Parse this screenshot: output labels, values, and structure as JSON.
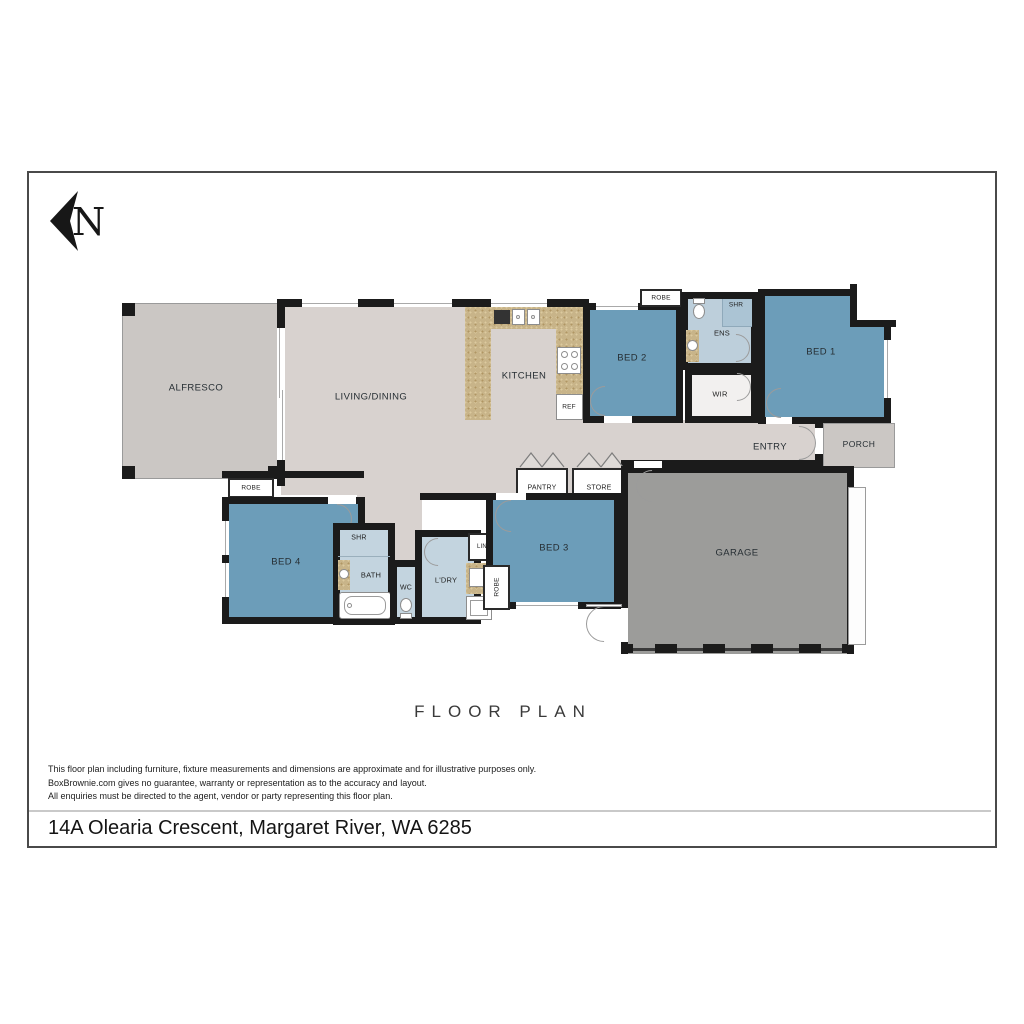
{
  "north": {
    "letter": "N"
  },
  "rooms": {
    "alfresco": "ALFRESCO",
    "living_dining": "LIVING/DINING",
    "kitchen": "KITCHEN",
    "ref": "REF",
    "bed2": "BED 2",
    "robe_bed2": "ROBE",
    "ens": "ENS",
    "shr_ens": "SHR",
    "wir": "WIR",
    "bed1": "BED 1",
    "entry": "ENTRY",
    "porch": "PORCH",
    "pantry": "PANTRY",
    "store": "STORE",
    "robe_bed4": "ROBE",
    "bed4": "BED 4",
    "shr_bath": "SHR",
    "bath": "BATH",
    "wc": "WC",
    "laundry": "L'DRY",
    "linen": "LIN",
    "robe_bed3": "ROBE",
    "bed3": "BED 3",
    "garage": "GARAGE"
  },
  "footer": {
    "title": "FLOOR PLAN",
    "disclaimer_line1": "This floor plan including furniture, fixture measurements and dimensions are approximate and for illustrative purposes only.",
    "disclaimer_line2": "BoxBrownie.com gives no guarantee, warranty or representation as to the accuracy and layout.",
    "disclaimer_line3": "All enquiries must be directed to the agent, vendor or party representing this floor plan.",
    "address": "14A Olearia Crescent, Margaret River, WA 6285"
  },
  "colors": {
    "bedroom_blue": "#6c9db9",
    "wet_area_blue": "#c3d4df",
    "ensuite_blue": "#bdcfdb",
    "shower_blue": "#abc4d4",
    "interior_floor": "#d8d2cf",
    "outdoor_gray": "#cbc7c4",
    "garage_gray": "#9c9c9a",
    "bench_tan": "#c8b489",
    "wall_black": "#1b1b1b"
  },
  "icons": [
    "north-arrow-icon",
    "toilet-icon",
    "basin-icon",
    "bathtub-icon",
    "kitchen-sink-icon",
    "cooktop-icon",
    "washing-machine-icon",
    "laundry-sink-icon",
    "bifold-door-icon",
    "door-swing-icon",
    "window",
    "wall"
  ]
}
